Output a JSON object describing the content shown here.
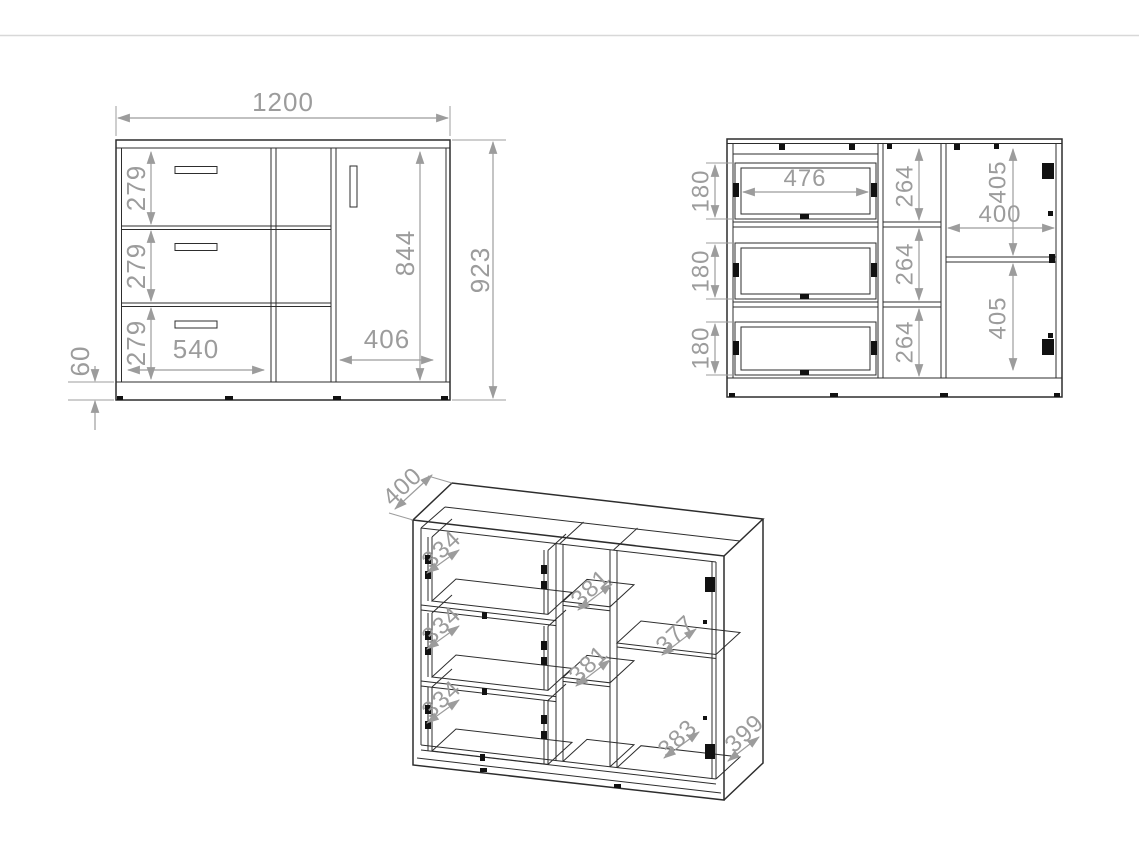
{
  "colors": {
    "background": "#ffffff",
    "outline": "#2d2d2d",
    "dimension": "#9c9c9c",
    "top_divider": "#d8d8d8"
  },
  "views": {
    "front": {
      "overall_width": "1200",
      "overall_height": "923",
      "door_height": "844",
      "drawer_front_heights": [
        "279",
        "279",
        "279"
      ],
      "drawer_width": "540",
      "door_width": "406",
      "plinth_height": "60"
    },
    "open_front": {
      "drawer_box_heights": [
        "180",
        "180",
        "180"
      ],
      "drawer_inner_width": "476",
      "middle_shelf_heights": [
        "264",
        "264",
        "264"
      ],
      "right_section_width": "400",
      "right_shelf_heights": [
        "405",
        "405"
      ]
    },
    "perspective": {
      "top_depth": "400",
      "drawer_box_depths": [
        "334",
        "334",
        "334"
      ],
      "middle_shelf_depths": [
        "381",
        "381"
      ],
      "right_shelf_depth": "377",
      "bottom_depth": "383",
      "side_depth": "399"
    }
  }
}
